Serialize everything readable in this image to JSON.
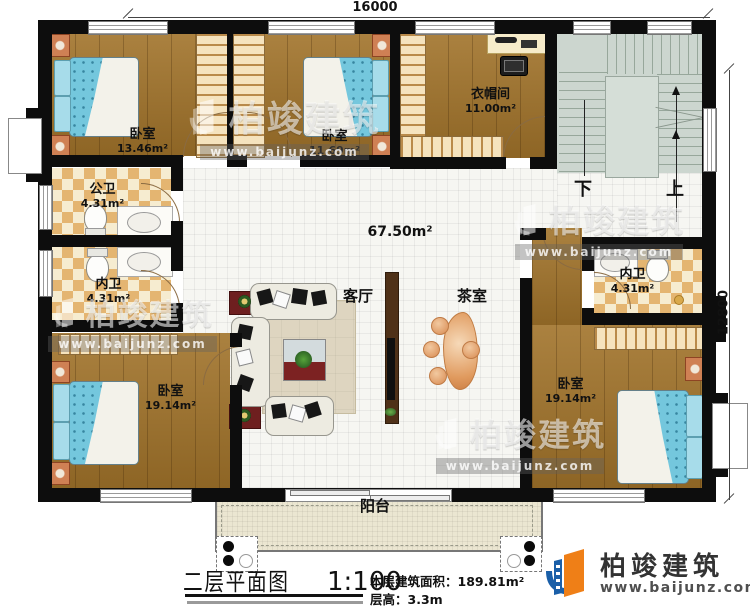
{
  "dimensions": {
    "top": "16000",
    "right": "12800"
  },
  "rooms": {
    "bedroom_tl": {
      "name": "卧室",
      "area": "13.46m²"
    },
    "bedroom_tm": {
      "name": "卧室",
      "area": "11.69m²"
    },
    "cloakroom": {
      "name": "衣帽间",
      "area": "11.00m²"
    },
    "public_bath": {
      "name": "公卫",
      "area": "4.31m²"
    },
    "inner_bath_left": {
      "name": "内卫",
      "area": "4.31m²"
    },
    "inner_bath_right": {
      "name": "内卫",
      "area": "4.31m²"
    },
    "living_room": {
      "name": "客厅"
    },
    "tea_room": {
      "name": "茶室"
    },
    "hall_area": "67.50m²",
    "bedroom_bl": {
      "name": "卧室",
      "area": "19.14m²"
    },
    "bedroom_br": {
      "name": "卧室",
      "area": "19.14m²"
    },
    "balcony": {
      "name": "阳台"
    }
  },
  "stairs": {
    "down": "下",
    "up": "上"
  },
  "title_block": {
    "title": "二层平面图",
    "scale": "1:100",
    "area_label": "本层建筑面积：",
    "area_value": "189.81m²",
    "floor_height_label": "层高：",
    "floor_height_value": "3.3m"
  },
  "branding": {
    "name": "柏竣建筑",
    "url": "www.baijunz.com"
  },
  "colors": {
    "wall": "#0d0d0d",
    "wood_floor": "#a1732a",
    "bed_blue": "#74c7dd",
    "tile_tan": "#e4b571",
    "stairs_gray": "#ccd6cf",
    "balcony_cream": "#ebe6d1",
    "logo_blue": "#1a5fa8",
    "logo_orange": "#ef7f17"
  }
}
